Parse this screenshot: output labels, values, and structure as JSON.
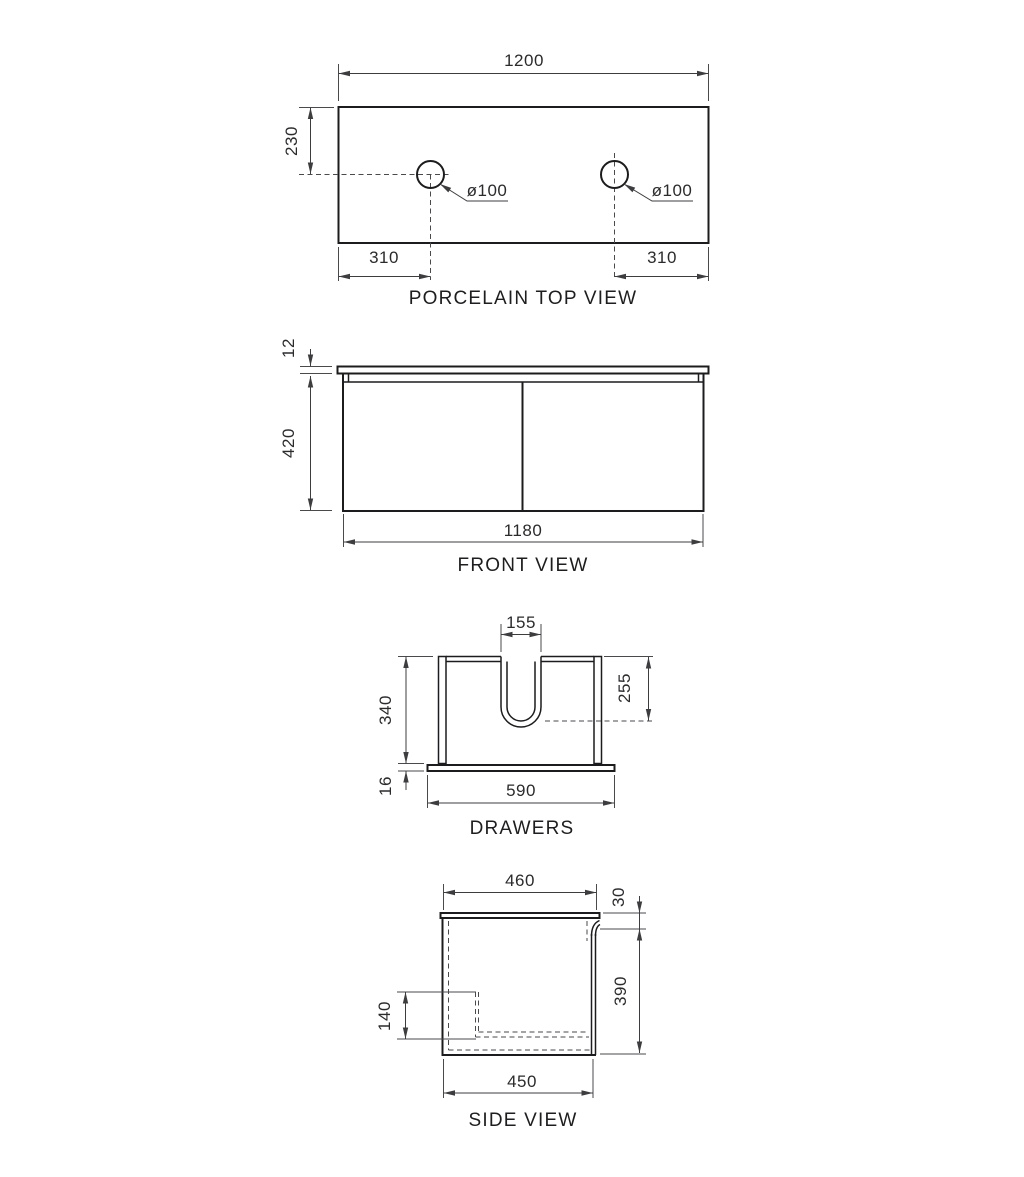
{
  "drawing": {
    "top_view": {
      "title": "PORCELAIN TOP VIEW",
      "dim_width": "1200",
      "dim_hole_setback": "230",
      "dim_hole_left": "ø100",
      "dim_hole_right": "ø100",
      "dim_offset_left": "310",
      "dim_offset_right": "310"
    },
    "front_view": {
      "title": "FRONT VIEW",
      "dim_top_thickness": "12",
      "dim_cabinet_height": "420",
      "dim_cabinet_width": "1180"
    },
    "drawers_view": {
      "title": "DRAWERS",
      "dim_notch_width": "155",
      "dim_drawer_height": "340",
      "dim_notch_depth": "255",
      "dim_base_thickness": "16",
      "dim_drawer_width": "590"
    },
    "side_view": {
      "title": "SIDE VIEW",
      "dim_top_depth": "460",
      "dim_top_gap": "30",
      "dim_body_height": "390",
      "dim_drawer_inner_height": "140",
      "dim_body_depth": "450"
    }
  }
}
